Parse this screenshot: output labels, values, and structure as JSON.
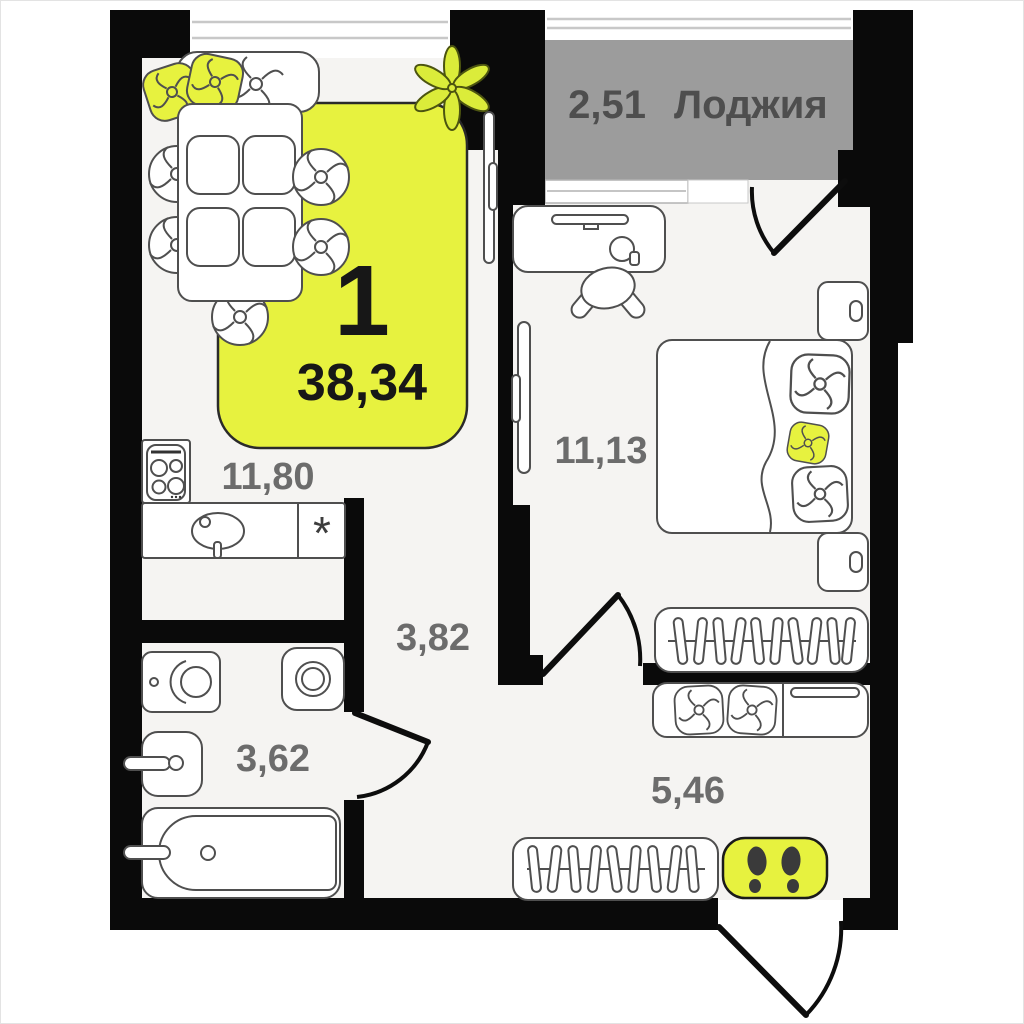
{
  "plan": {
    "badge": {
      "rooms_count": "1",
      "total_area": "38,34"
    },
    "loggia": {
      "area": "2,51",
      "name": "Лоджия"
    },
    "areas": {
      "kitchen_living": "11,80",
      "bedroom": "11,13",
      "hallway": "3,82",
      "bathroom": "3,62",
      "entry": "5,46"
    },
    "symbols": {
      "fridge": "*"
    },
    "icons": {
      "entrance": "footprints-icon",
      "plant": "plant-icon",
      "stove": "stove-icon",
      "kitchen_sink": "sink-icon",
      "bathtub": "bathtub-icon",
      "washer": "washing-machine-icon",
      "toilet": "toilet-icon",
      "wardrobes": "hangers-icon",
      "bed": "bed-icon",
      "desk": "desk-icon"
    },
    "colors": {
      "accent_yellow": "#e7f23f",
      "wall_black": "#0a0a0a",
      "loggia_gray": "#9c9c9c",
      "floor_gray": "#f5f4f2",
      "label_gray": "#6c6c6c"
    }
  }
}
